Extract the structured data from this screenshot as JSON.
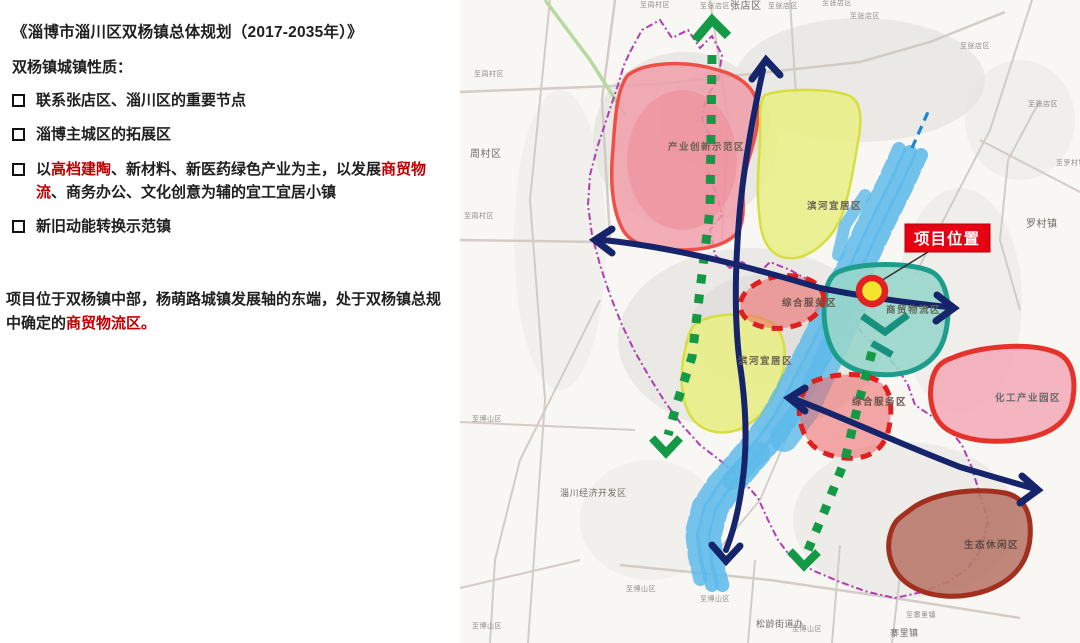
{
  "left_panel": {
    "title": "《淄博市淄川区双杨镇总体规划（2017-2035年）》",
    "subtitle": "双杨镇城镇性质：",
    "text_color": "#1f1f1f",
    "accent_color": "#c00000",
    "bullets": [
      {
        "segments": [
          {
            "t": "联系张店区、淄川区的重要节点",
            "c": "#1f1f1f"
          }
        ]
      },
      {
        "segments": [
          {
            "t": "淄博主城区的拓展区",
            "c": "#1f1f1f"
          }
        ]
      },
      {
        "segments": [
          {
            "t": "以",
            "c": "#1f1f1f"
          },
          {
            "t": "高档建陶",
            "c": "#c00000"
          },
          {
            "t": "、新材料、新医药绿色产业为主，以发展",
            "c": "#1f1f1f"
          },
          {
            "t": "商贸物流",
            "c": "#c00000"
          },
          {
            "t": "、商务办公、文化创意为辅的宜工宜居小镇",
            "c": "#1f1f1f"
          }
        ]
      },
      {
        "segments": [
          {
            "t": "新旧动能转换示范镇",
            "c": "#1f1f1f"
          }
        ]
      }
    ],
    "paragraph": {
      "segments": [
        {
          "t": "项目位于双杨镇中部，杨萌路城镇发展轴的东端，处于双杨镇总规中确定的",
          "c": "#1f1f1f"
        },
        {
          "t": "商贸物流区。",
          "c": "#c00000"
        }
      ]
    }
  },
  "map": {
    "project_flag": {
      "label": "项目位置",
      "bg": "#e60012",
      "text_color": "#ffffff"
    },
    "colors": {
      "boundary_purple": "#b23cb2",
      "axis_navy": "#16256b",
      "axis_green": "#149a47",
      "river_blue": "#5cb9ea",
      "river_dash_blue": "#1b87d4",
      "innovation_zone_red": "#ef4f46",
      "livable_zone_yellow": "#d6df3f",
      "logistics_zone_teal": "#1d9e8c",
      "service_zone_red": "#e01f1f",
      "chemical_zone_red": "#e5332b",
      "eco_zone_brown": "#a2301f"
    },
    "zone_labels": [
      {
        "text": "产业创新示范区",
        "x": 208,
        "y": 150,
        "size": 9.5,
        "color": "#6b6352"
      },
      {
        "text": "滨河宜居区",
        "x": 347,
        "y": 209,
        "size": 9.5,
        "color": "#6b6352"
      },
      {
        "text": "商贸物流区",
        "x": 426,
        "y": 313,
        "size": 9.5,
        "color": "#5f6a5a"
      },
      {
        "text": "综合服务区",
        "x": 322,
        "y": 306,
        "size": 9.5,
        "color": "#6b5147"
      },
      {
        "text": "综合服务区",
        "x": 392,
        "y": 405,
        "size": 9.5,
        "color": "#6b5147"
      },
      {
        "text": "滨河宜居区",
        "x": 278,
        "y": 364,
        "size": 9.5,
        "color": "#6b6352"
      },
      {
        "text": "化工产业园区",
        "x": 535,
        "y": 401,
        "size": 9.5,
        "color": "#6a6a6a"
      },
      {
        "text": "生态休闲区",
        "x": 504,
        "y": 548,
        "size": 9.5,
        "color": "#5d4a42"
      }
    ],
    "area_labels": [
      {
        "text": "至周村区",
        "x": 180,
        "y": 7,
        "size": 7,
        "color": "#8e8a84"
      },
      {
        "text": "至张店区",
        "x": 240,
        "y": 8,
        "size": 7,
        "color": "#8e8a84"
      },
      {
        "text": "张店区",
        "x": 270,
        "y": 9,
        "size": 10,
        "color": "#6f6b64"
      },
      {
        "text": "至张店区",
        "x": 308,
        "y": 8,
        "size": 7,
        "color": "#8e8a84"
      },
      {
        "text": "至张店区",
        "x": 362,
        "y": 5,
        "size": 7,
        "color": "#8e8a84"
      },
      {
        "text": "至张店区",
        "x": 390,
        "y": 18,
        "size": 7,
        "color": "#8e8a84"
      },
      {
        "text": "至张店区",
        "x": 500,
        "y": 48,
        "size": 7,
        "color": "#8e8a84"
      },
      {
        "text": "至张店区",
        "x": 568,
        "y": 106,
        "size": 7,
        "color": "#8e8a84"
      },
      {
        "text": "至罗村镇",
        "x": 596,
        "y": 165,
        "size": 7,
        "color": "#8e8a84"
      },
      {
        "text": "罗村镇",
        "x": 566,
        "y": 227,
        "size": 10,
        "color": "#6f6b64"
      },
      {
        "text": "至周村区",
        "x": 14,
        "y": 76,
        "size": 7,
        "color": "#8e8a84"
      },
      {
        "text": "周村区",
        "x": 10,
        "y": 157,
        "size": 10,
        "color": "#6f6b64"
      },
      {
        "text": "至周村区",
        "x": 4,
        "y": 218,
        "size": 7,
        "color": "#8e8a84"
      },
      {
        "text": "至博山区",
        "x": 12,
        "y": 421,
        "size": 7,
        "color": "#8e8a84"
      },
      {
        "text": "淄川经济开发区",
        "x": 100,
        "y": 496,
        "size": 9,
        "color": "#6f6b64"
      },
      {
        "text": "至博山区",
        "x": 12,
        "y": 628,
        "size": 7,
        "color": "#8e8a84"
      },
      {
        "text": "至博山区",
        "x": 166,
        "y": 591,
        "size": 7,
        "color": "#8e8a84"
      },
      {
        "text": "至博山区",
        "x": 240,
        "y": 601,
        "size": 7,
        "color": "#8e8a84"
      },
      {
        "text": "松龄街道办",
        "x": 296,
        "y": 627,
        "size": 9,
        "color": "#6f6b64"
      },
      {
        "text": "至博山区",
        "x": 332,
        "y": 631,
        "size": 7,
        "color": "#8e8a84"
      },
      {
        "text": "至寨里镇",
        "x": 446,
        "y": 617,
        "size": 7,
        "color": "#8e8a84"
      },
      {
        "text": "寨里镇",
        "x": 430,
        "y": 636,
        "size": 9,
        "color": "#6f6b64"
      }
    ]
  }
}
